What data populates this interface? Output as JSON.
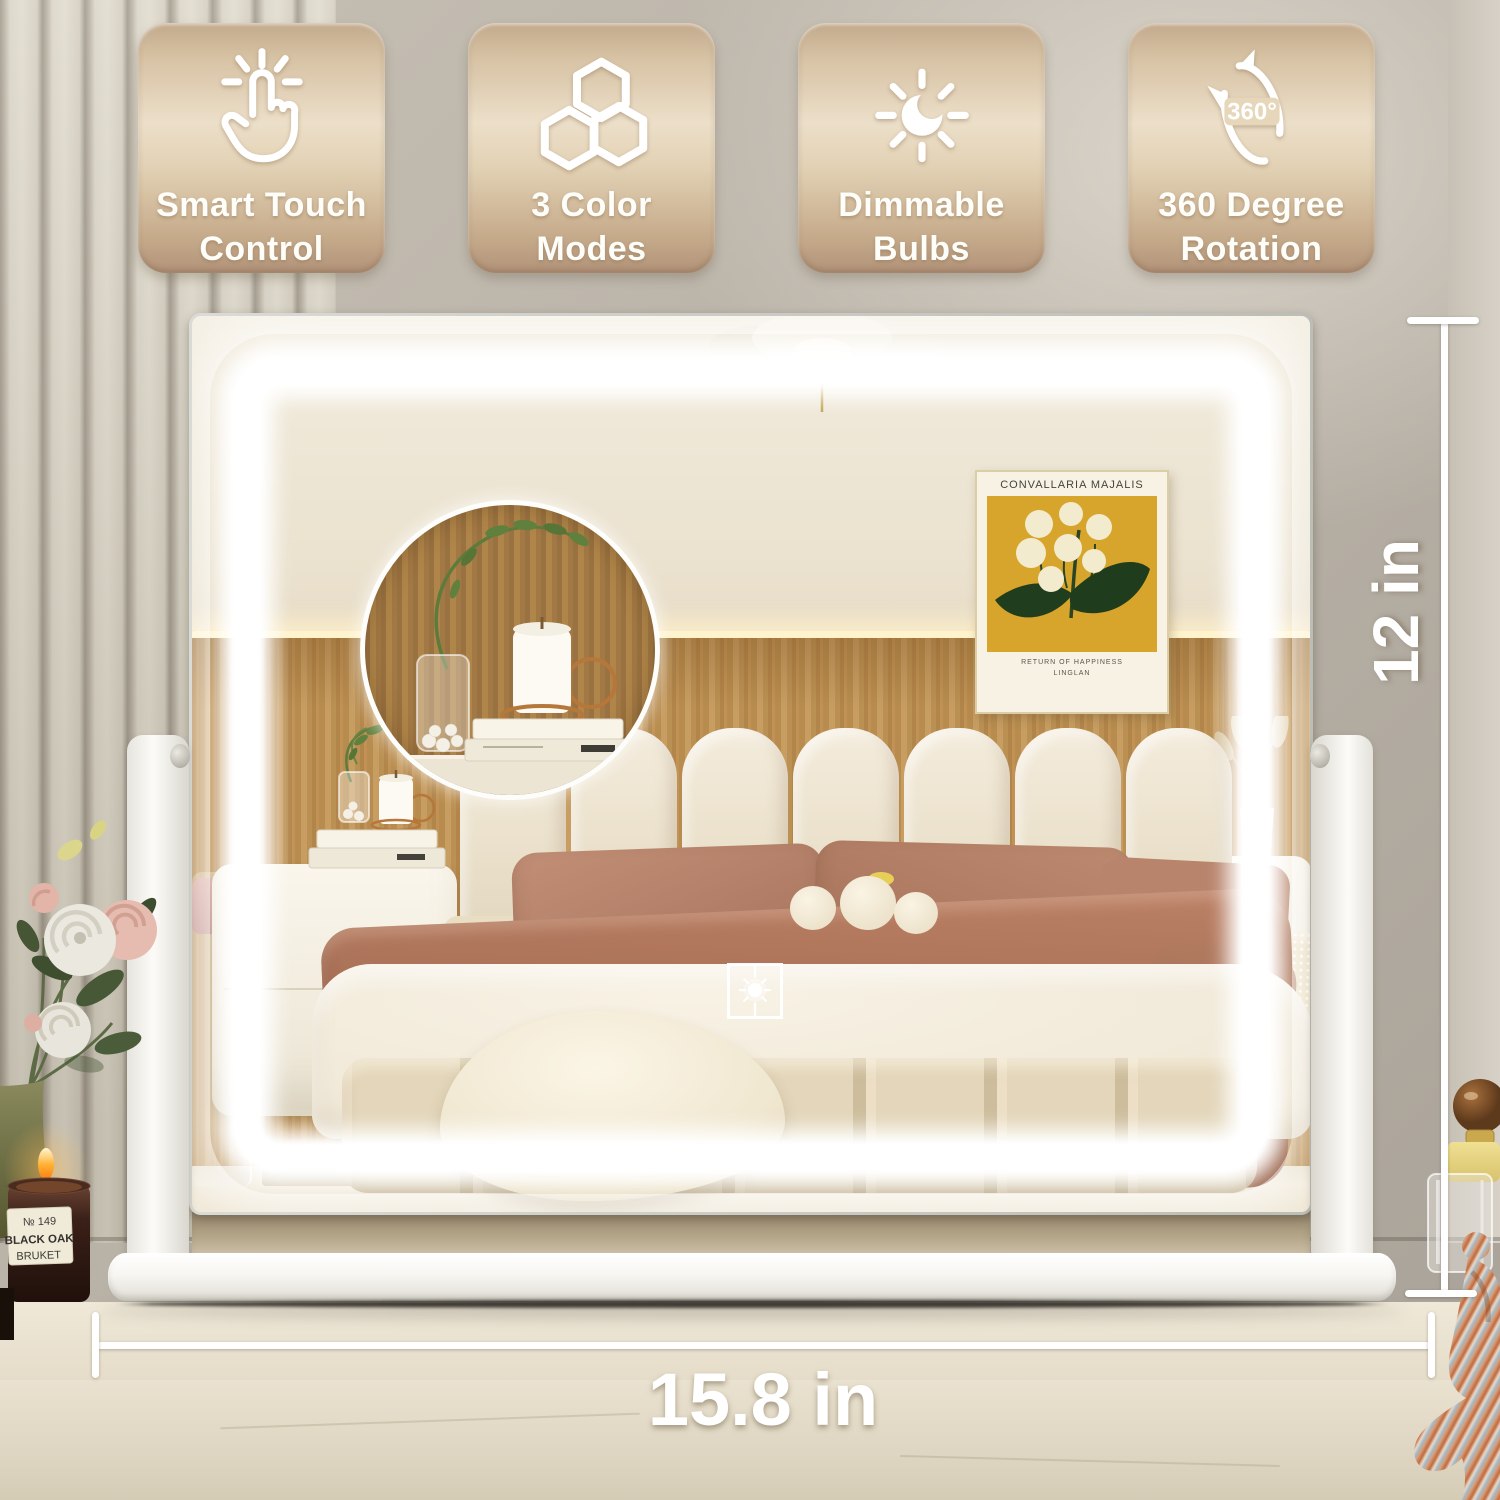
{
  "badges": [
    {
      "line1": "Smart Touch",
      "line2": "Control",
      "icon": "touch-icon"
    },
    {
      "line1": "3 Color",
      "line2": "Modes",
      "icon": "color-modes-icon"
    },
    {
      "line1": "Dimmable",
      "line2": "Bulbs",
      "icon": "brightness-icon"
    },
    {
      "line1": "360 Degree",
      "line2": "Rotation",
      "icon": "rotation-icon",
      "icon_text": "360°"
    }
  ],
  "dimensions": {
    "height_label": "12 in",
    "width_label": "15.8 in"
  },
  "mirror": {
    "art_print": {
      "title": "CONVALLARIA MAJALIS",
      "caption_line1": "RETURN OF HAPPINESS",
      "caption_line2": "LINGLAN"
    },
    "touch_button_icon": "sun-icon"
  },
  "candle": {
    "number": "№ 149",
    "name": "BLACK OAK",
    "brand": "BRUKET"
  },
  "colors": {
    "badge_tan": "#d9c4a6",
    "led_white": "#ffffff",
    "wall_taupe": "#b9b2a7",
    "slat_cream": "#d9d4c5",
    "wood_panel": "#bf9557",
    "art_mustard": "#d7a42c",
    "terracotta_pillow": "#b5826a",
    "rust_throw": "#ac7258",
    "counter_marble": "#ebe4d3",
    "base_white": "#fafaf7"
  }
}
